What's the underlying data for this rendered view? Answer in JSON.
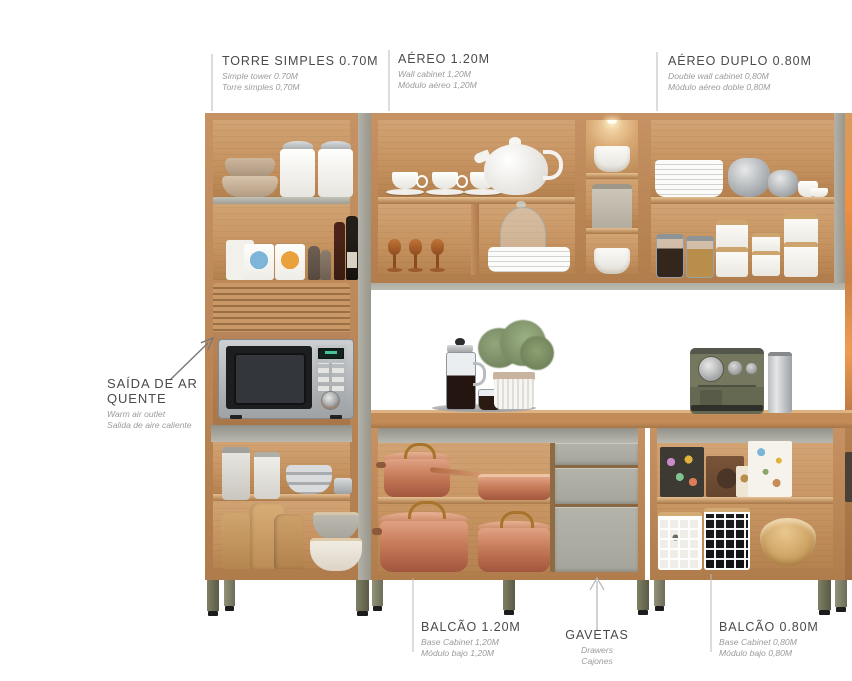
{
  "labels": {
    "torre": {
      "title": "TORRE SIMPLES 0.70M",
      "sub1": "Simple tower 0.70M",
      "sub2": "Torre simples 0,70M"
    },
    "aereo": {
      "title": "AÉREO 1.20M",
      "sub1": "Wall cabinet 1,20M",
      "sub2": "Módulo aéreo 1,20M"
    },
    "aereo_duplo": {
      "title": "AÉREO DUPLO 0.80M",
      "sub1": "Double wall cabinet 0,80M",
      "sub2": "Módulo aéreo doble 0,80M"
    },
    "saida": {
      "title": "SAÍDA DE AR QUENTE",
      "sub1": "Warm air outlet",
      "sub2": "Salida de aire caliente"
    },
    "balcao_120": {
      "title": "BALCÃO 1.20M",
      "sub1": "Base Cabinet 1,20M",
      "sub2": "Módulo bajo 1,20M"
    },
    "gavetas": {
      "title": "GAVETAS",
      "sub1": "Drawers",
      "sub2": "Cajones"
    },
    "balcao_080": {
      "title": "BALCÃO 0.80M",
      "sub1": "Base Cabinet 0,80M",
      "sub2": "Módulo bajo 0,80M"
    }
  },
  "colors": {
    "wood": "#bf8a58",
    "wood_interior": "#cb9a6a",
    "panel_gray": "#a9a89e",
    "drawer_gray": "#aeada3",
    "leg_olive": "#73735a",
    "copper": "#c67b59",
    "label_title": "#4a4a4a",
    "label_subtitle": "#9b9b9b",
    "leader_line": "#b9b9b9"
  }
}
